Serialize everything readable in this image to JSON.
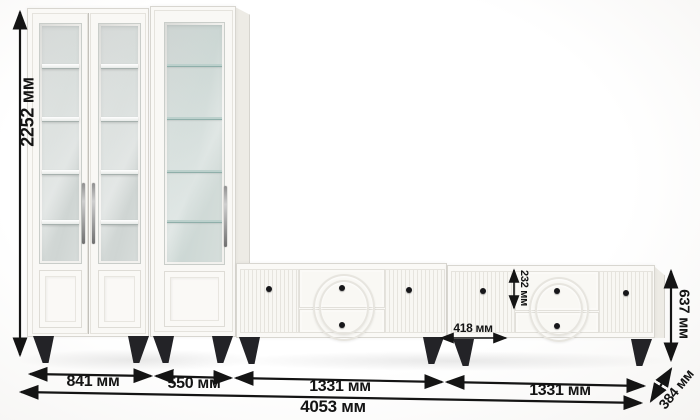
{
  "title": "Furniture set dimension diagram",
  "units": "мм",
  "dimensions": {
    "total_height": "2252 мм",
    "bookcase_double_width": "841 мм",
    "bookcase_single_width": "550 мм",
    "tv_stand_left_width": "1331 мм",
    "tv_stand_right_width": "1331 мм",
    "total_width": "4053 мм",
    "tv_stand_height": "637 мм",
    "tv_stand_depth": "384 мм",
    "drawer_height": "232 мм",
    "tv_door_width": "418 мм"
  },
  "colors": {
    "dimension_line": "#141414",
    "furniture_white": "#faf9f6",
    "furniture_border": "#d8d6d0",
    "glass": "#d5dbd9",
    "leg_black": "#232327"
  }
}
